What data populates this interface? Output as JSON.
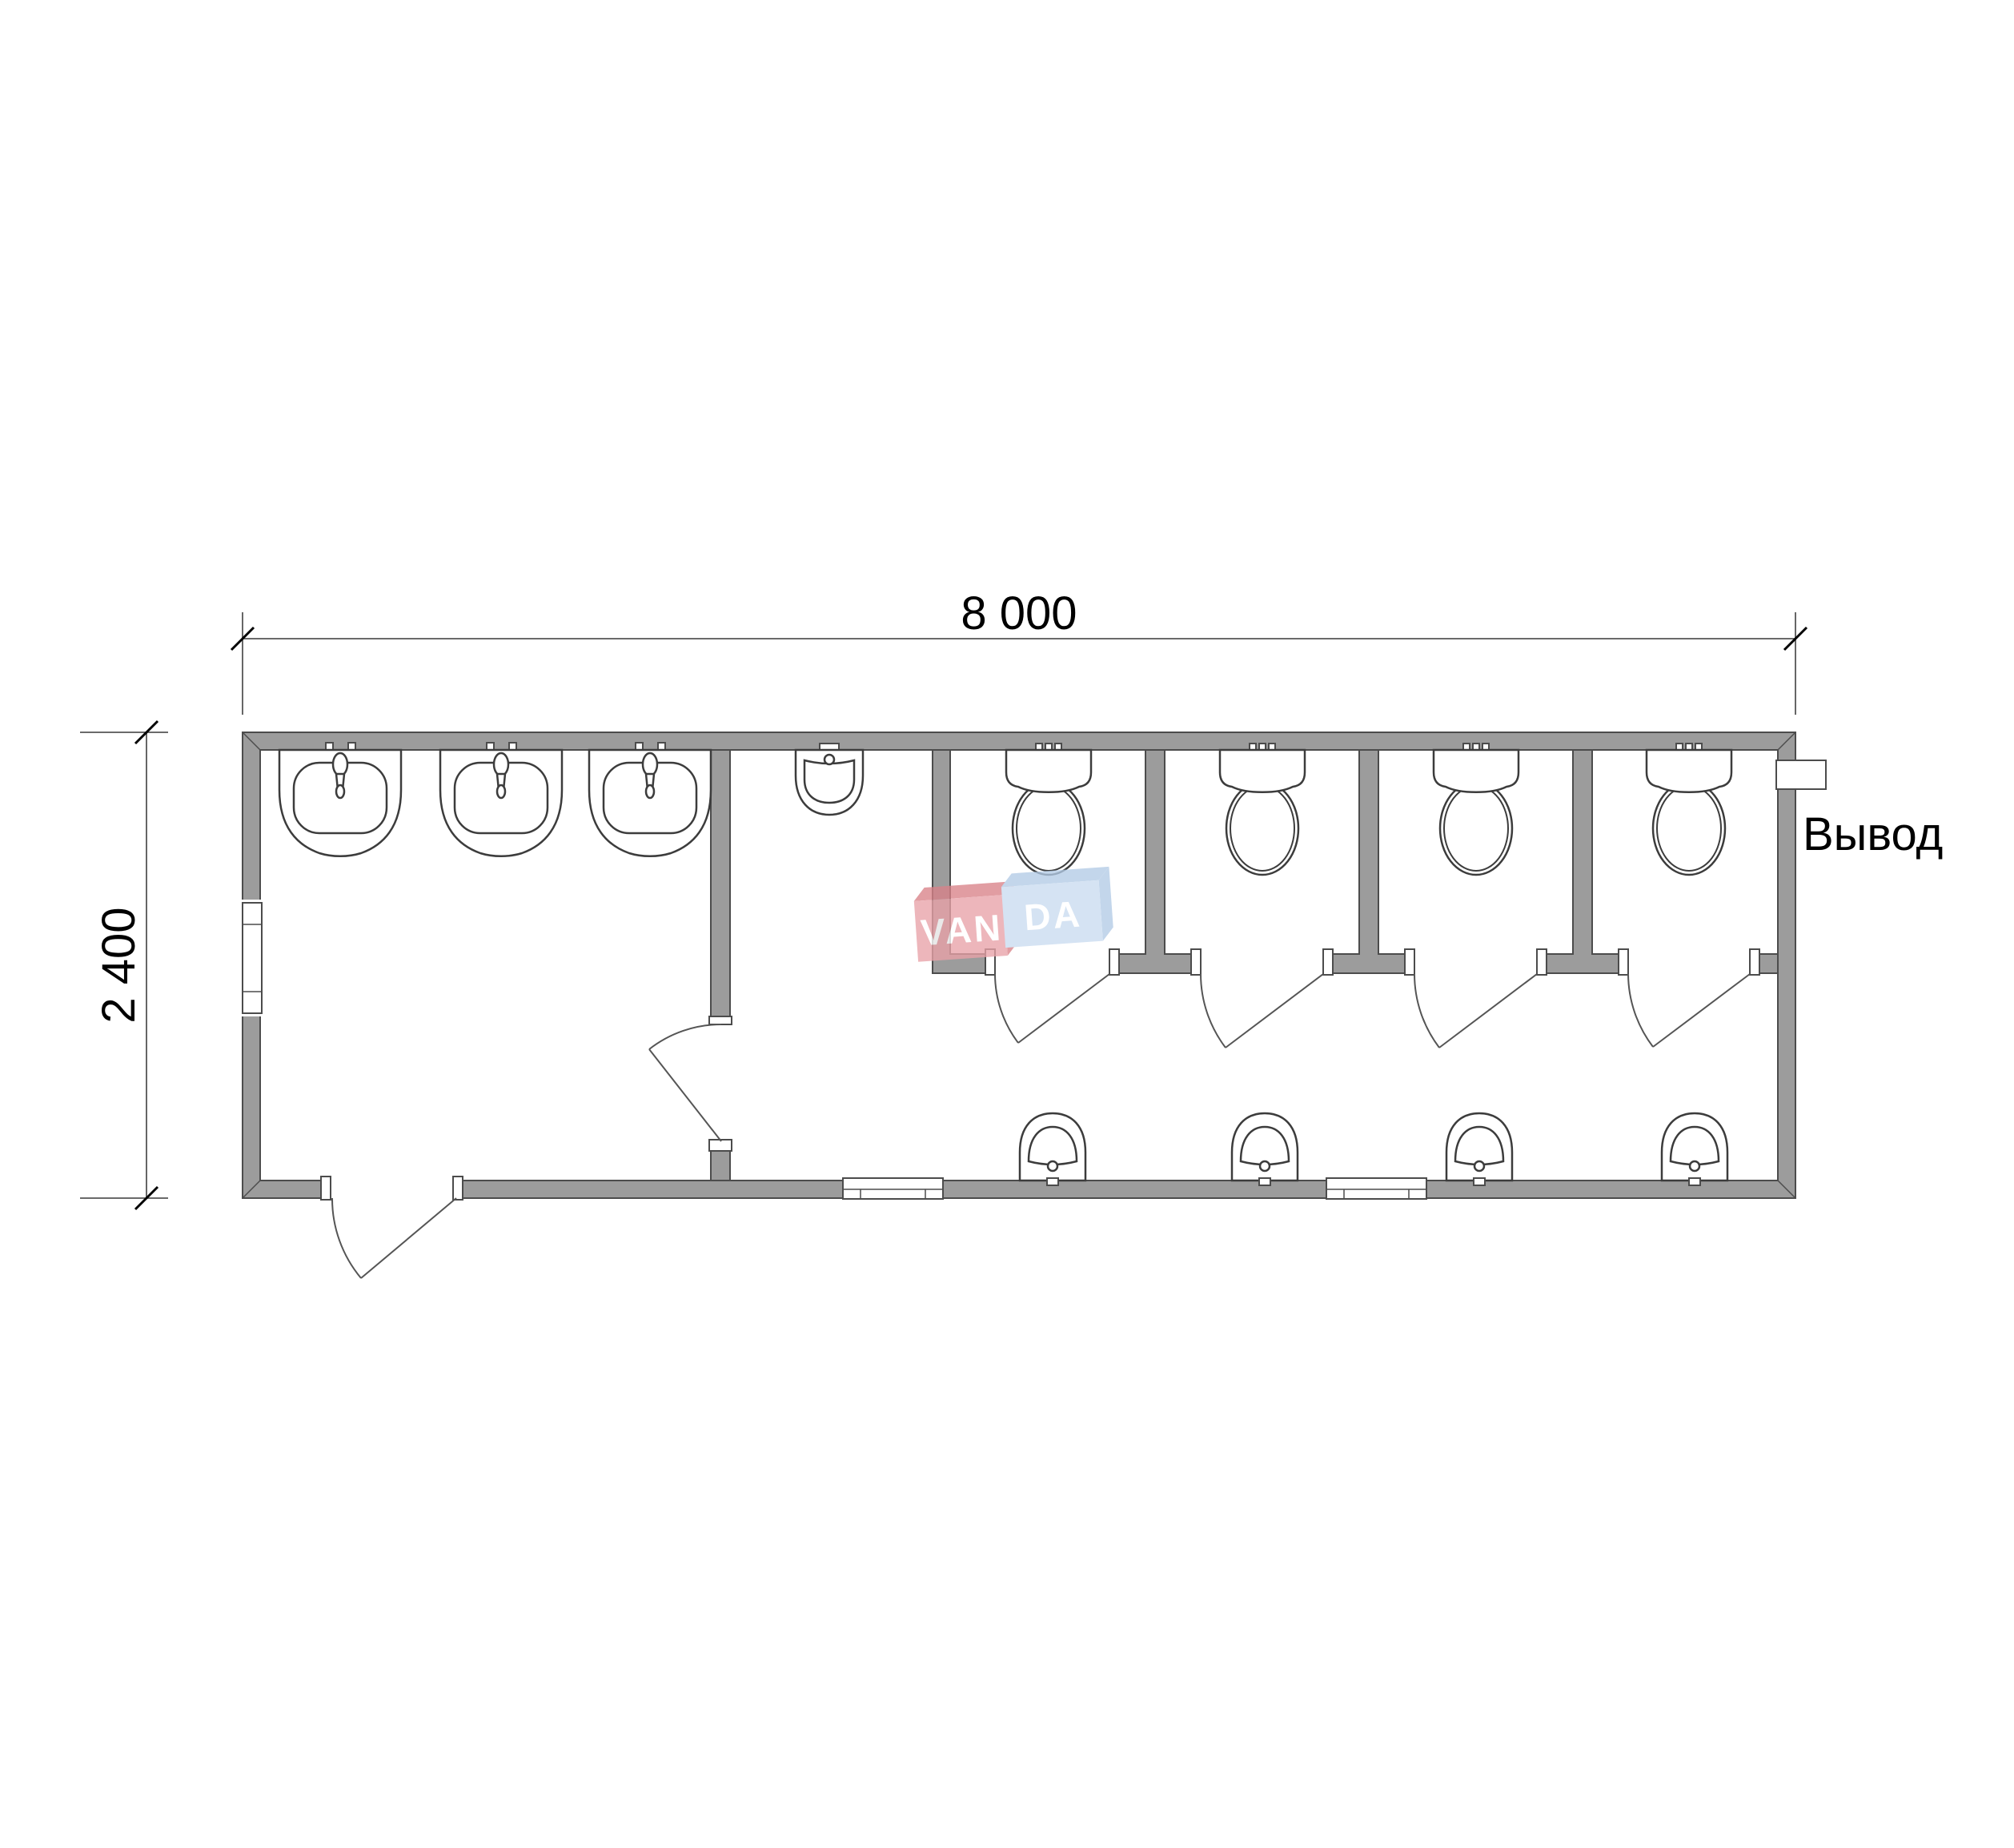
{
  "dimensions": {
    "width_label": "8 000",
    "height_label": "2 400"
  },
  "labels": {
    "outlet": "Вывод"
  },
  "watermark": {
    "left": "VAN",
    "right": "DA"
  },
  "colors": {
    "bg": "#ffffff",
    "wall": "#9c9c9c",
    "line": "#4c4c4c",
    "fixture-line": "#3c3c3c",
    "dim-line": "#555555",
    "text": "#000000",
    "logo-pink": "#e9a2a8",
    "logo-pink-dark": "#d98289",
    "logo-blue": "#cadcf0",
    "logo-blue-dark": "#b3cbe6",
    "logo-text": "#ffffff"
  }
}
